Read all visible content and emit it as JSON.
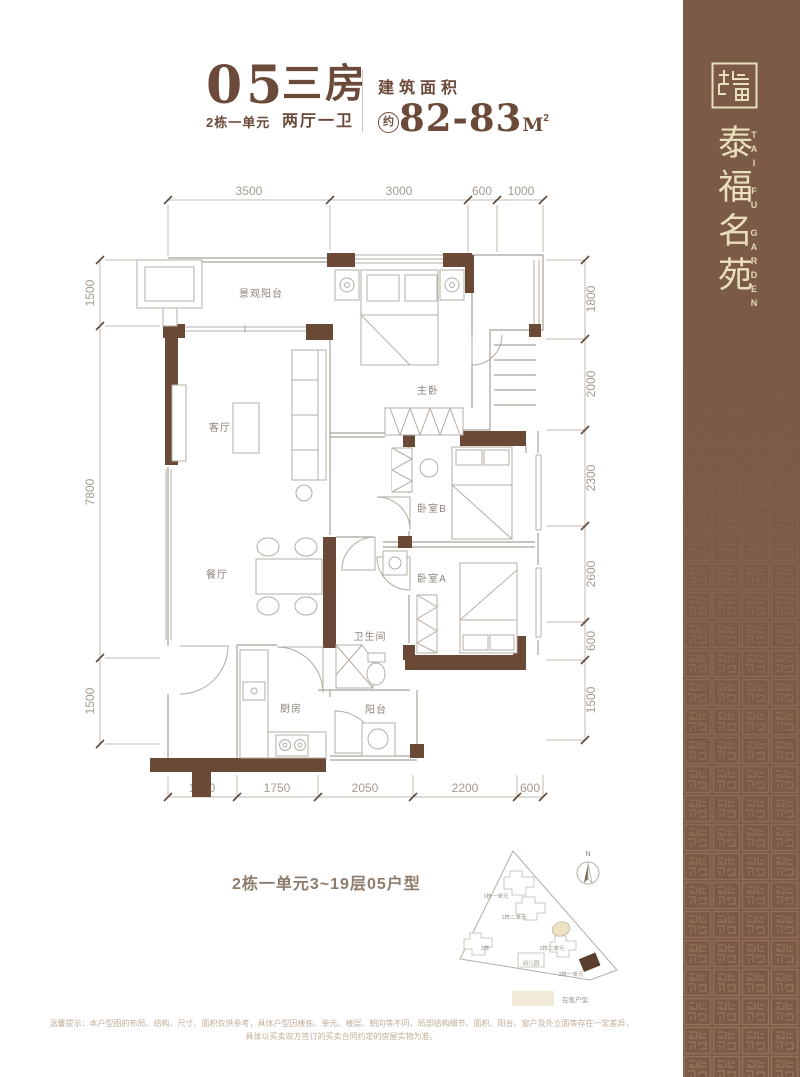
{
  "header": {
    "unit_number": "05",
    "unit_block": "2栋一单元",
    "rooms_title": "三房",
    "rooms_sub": "两厅一卫",
    "area_label": "建筑面积",
    "area_prefix": "约",
    "area_value": "82-83",
    "area_unit": "M",
    "area_sup": "2"
  },
  "sidebar": {
    "brand_cn": "泰福名苑",
    "brand_en": "TAI FU GARDEN"
  },
  "floorplan": {
    "rooms": {
      "view_balcony": "景观阳台",
      "living": "客厅",
      "dining": "餐厅",
      "kitchen": "厨房",
      "balcony": "阳台",
      "bathroom": "卫生间",
      "master": "主卧",
      "bedroom_b": "卧室B",
      "bedroom_a": "卧室A"
    },
    "dims_top": [
      "3500",
      "3000",
      "600",
      "1000"
    ],
    "dims_bottom": [
      "1500",
      "1750",
      "2050",
      "2200",
      "600"
    ],
    "dims_left": [
      "1500",
      "7800",
      "1500"
    ],
    "dims_right": [
      "1800",
      "2000",
      "2300",
      "2600",
      "600",
      "1500"
    ]
  },
  "caption": "2栋一单元3~19层05户型",
  "siteplan": {
    "north": "N",
    "buildings": [
      "1栋一单元",
      "1栋二单元",
      "3栋",
      "2栋二单元",
      "幼儿园",
      "2栋一单元"
    ],
    "legend": "在售户型"
  },
  "disclaimer": {
    "line1": "温馨提示：本户型图的布局、结构、尺寸、面积仅供参考，具体户型因楼栋、单元、楼层、朝向等不同，局部结构细节、面积、阳台、窗户及外立面等存在一定差异，",
    "line2": "具体以买卖双方签订的买卖合同约定的房屋实物为准。"
  },
  "colors": {
    "brand_brown": "#7b5a46",
    "accent_brown": "#6b4a3a",
    "cream": "#eadfbd",
    "wall_brown": "#6a4936",
    "highlight_dark": "#5a3f2e",
    "highlight_beige": "#efe8cd"
  }
}
